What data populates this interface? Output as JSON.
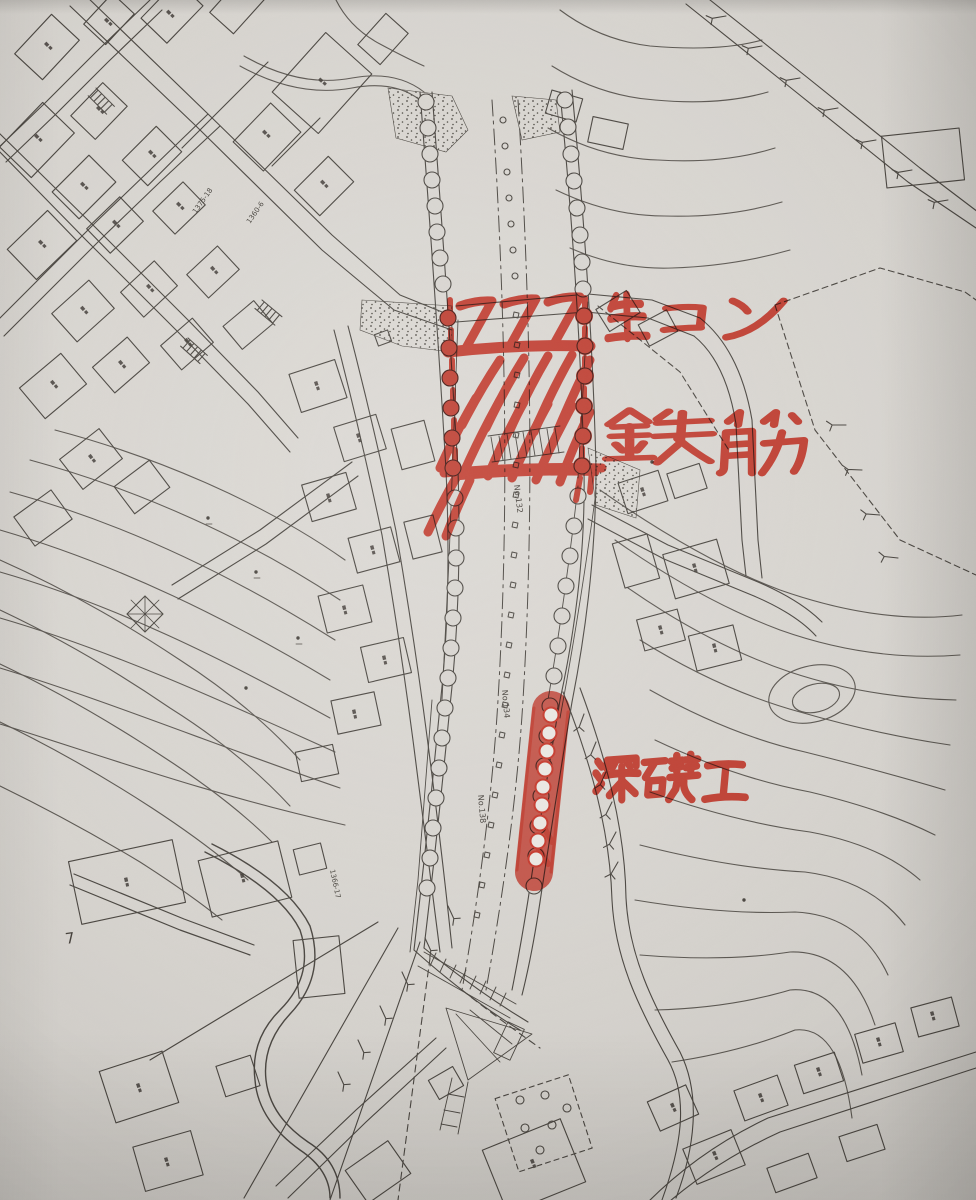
{
  "photo": {
    "description": "Hand-annotated construction site plan photo",
    "paper_color": "#d8d5d0",
    "ink_color": "#49453f",
    "marker_color": "#e03827"
  },
  "annotations": {
    "ready_mix_concrete": {
      "text": "生コン"
    },
    "rebar": {
      "text": "鉄筋"
    },
    "deep_foundation": {
      "text": "深礎工"
    }
  },
  "map_labels": {
    "sheet_number": "7",
    "station_labels": [
      "No.132",
      "No.134",
      "No.138"
    ],
    "parcel_numbers": [
      "1375-18",
      "1360-6",
      "1366-17"
    ]
  }
}
